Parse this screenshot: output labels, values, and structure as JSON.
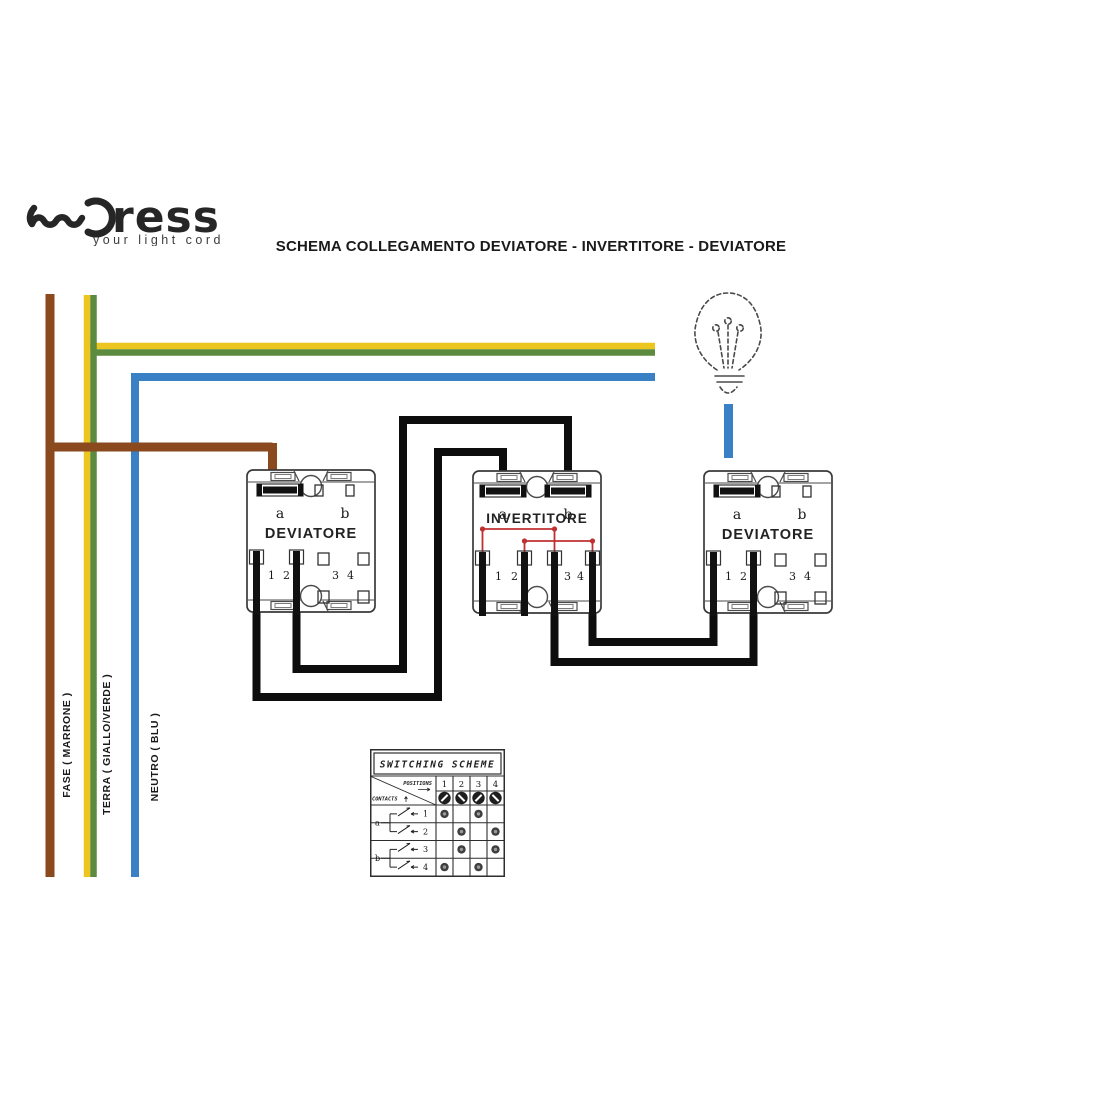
{
  "brand": {
    "name": "ress",
    "tagline": "your light cord"
  },
  "title": "SCHEMA COLLEGAMENTO DEVIATORE - INVERTITORE - DEVIATORE",
  "wire_labels": {
    "fase": "FASE ( MARRONE )",
    "terra": "TERRA ( GIALLO/VERDE )",
    "neutro": "NEUTRO ( BLU )"
  },
  "colors": {
    "brown": "#8a4a1e",
    "yellow": "#ecc51f",
    "green": "#5c8a3e",
    "blue": "#3a80c4",
    "black": "#0d0d0d",
    "red": "#c03030",
    "dot": "#3f3f3f",
    "dot_center": "#9a9a9a",
    "knob": "#1e1e1e"
  },
  "icons": {
    "bulb": "light-bulb-icon",
    "logo_wave": "wave-logo-icon"
  },
  "switches": [
    {
      "label": "DEVIATORE",
      "a": "a",
      "b": "b",
      "t1": "1",
      "t2": "2",
      "t3": "3",
      "t4": "4"
    },
    {
      "label": "INVERTITORE",
      "a": "a",
      "b": "b",
      "t1": "1",
      "t2": "2",
      "t3": "3",
      "t4": "4"
    },
    {
      "label": "DEVIATORE",
      "a": "a",
      "b": "b",
      "t1": "1",
      "t2": "2",
      "t3": "3",
      "t4": "4"
    }
  ],
  "table": {
    "title": "SWITCHING SCHEME",
    "corner_top": "POSITIONS",
    "corner_bottom": "CONTACTS",
    "positions": [
      "1",
      "2",
      "3",
      "4"
    ],
    "knob_angles": [
      135,
      45,
      135,
      45
    ],
    "groups": [
      {
        "label": "a"
      },
      {
        "label": "b"
      }
    ],
    "rows": [
      "1",
      "2",
      "3",
      "4"
    ],
    "matrix": [
      [
        1,
        0,
        1,
        0
      ],
      [
        0,
        1,
        0,
        1
      ],
      [
        0,
        1,
        0,
        1
      ],
      [
        1,
        0,
        1,
        0
      ]
    ]
  }
}
